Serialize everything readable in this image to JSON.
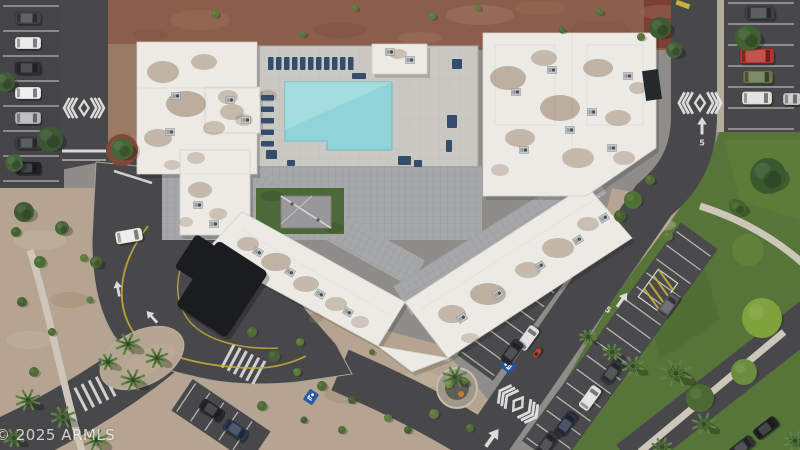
{
  "watermark": {
    "text": "© 2025 ARMLS"
  },
  "road_markings": {
    "speed_label": "5"
  },
  "palette": {
    "asphalt": "#48484a",
    "asphalt_dark": "#434345",
    "roof": "#eceae5",
    "stain": "#8b7057",
    "dirt": "#8b5e4c",
    "gravel": "#b5a491",
    "lawn": "#577539",
    "pool": "#8ed4d8",
    "deck": "#cac8c3",
    "tile": "#a6a7a9",
    "canopy": "#1b1c1f",
    "line_white": "#e8e8e6",
    "line_yellow": "#c8b13b",
    "courtyard_green": "#4c6a38",
    "sidewalk": "#cdc7ba",
    "furniture_blue": "#2b4767",
    "brick": "#7c3f33",
    "mulch": "#7c4a37"
  },
  "scene": {
    "stall_rows": [
      {
        "cx": 31,
        "cy": 94,
        "len": 176,
        "width": 56,
        "step": 25,
        "rot": 90,
        "apron": null
      },
      {
        "cx": 761,
        "cy": 67,
        "len": 128,
        "width": 66,
        "step": 21,
        "rot": 90,
        "apron": null
      },
      {
        "cx": 528,
        "cy": 295,
        "len": 170,
        "width": 40,
        "step": 17,
        "rot": -54,
        "apron": "#4a4a4c"
      },
      {
        "cx": 620,
        "cy": 345,
        "len": 260,
        "width": 42,
        "step": 17,
        "rot": -54,
        "apron": "#4a4a4c"
      },
      {
        "cx": 221,
        "cy": 421,
        "len": 84,
        "width": 34,
        "step": 17,
        "rot": 34,
        "apron": "#48484a"
      }
    ],
    "chevrons": [
      {
        "x": 84,
        "y": 108,
        "rot": 0,
        "s": 0.85
      },
      {
        "x": 700,
        "y": 103,
        "rot": 0,
        "s": 0.9
      },
      {
        "x": 518,
        "y": 404,
        "rot": 36,
        "s": 0.95
      }
    ],
    "arrows": [
      {
        "x": 702,
        "y": 126,
        "rot": 0,
        "s": 1
      },
      {
        "x": 622,
        "y": 300,
        "rot": 36,
        "s": 1
      },
      {
        "x": 492,
        "y": 438,
        "rot": 36,
        "s": 1.25
      },
      {
        "x": 268,
        "y": 186,
        "rot": 92,
        "s": 0.9
      },
      {
        "x": 118,
        "y": 289,
        "rot": -10,
        "s": 0.9
      },
      {
        "x": 152,
        "y": 317,
        "rot": -42,
        "s": 0.9
      }
    ],
    "speed_markers": [
      {
        "x": 702,
        "y": 143,
        "rot": 0
      },
      {
        "x": 608,
        "y": 310,
        "rot": 36
      }
    ],
    "handicap": [
      {
        "x": 508,
        "y": 366,
        "rot": -54
      },
      {
        "x": 311,
        "y": 397,
        "rot": 34
      },
      {
        "x": 572,
        "y": 252,
        "rot": -54
      },
      {
        "x": 578,
        "y": 266,
        "rot": -54
      }
    ],
    "cars": [
      {
        "x": 28,
        "y": 18,
        "rot": 0,
        "c": "#43464a"
      },
      {
        "x": 28,
        "y": 43,
        "rot": 0,
        "c": "#e7e7e5"
      },
      {
        "x": 28,
        "y": 68,
        "rot": 0,
        "c": "#2d3034"
      },
      {
        "x": 28,
        "y": 93,
        "rot": 0,
        "c": "#ecedee"
      },
      {
        "x": 28,
        "y": 118,
        "rot": 0,
        "c": "#b4b6b8"
      },
      {
        "x": 28,
        "y": 143,
        "rot": 0,
        "c": "#3c4043"
      },
      {
        "x": 28,
        "y": 168,
        "rot": 0,
        "c": "#202225"
      },
      {
        "x": 760,
        "y": 13,
        "rot": 0,
        "c": "#3f4245",
        "w": 30,
        "h": 13
      },
      {
        "x": 757,
        "y": 56,
        "rot": 0,
        "c": "#b5352d",
        "w": 34,
        "h": 15
      },
      {
        "x": 758,
        "y": 77,
        "rot": 0,
        "c": "#66754b",
        "w": 30,
        "h": 13
      },
      {
        "x": 757,
        "y": 98,
        "rot": 0,
        "c": "#dedfdd",
        "w": 30,
        "h": 13
      },
      {
        "x": 792,
        "y": 99,
        "rot": 0,
        "c": "#c8c9c9",
        "w": 18,
        "h": 12
      },
      {
        "x": 129,
        "y": 236,
        "rot": -10,
        "c": "#ebebe9",
        "w": 27,
        "h": 13
      },
      {
        "x": 528,
        "y": 338,
        "rot": -54,
        "c": "#dcdddc"
      },
      {
        "x": 512,
        "y": 352,
        "rot": -54,
        "c": "#2e3134"
      },
      {
        "x": 537,
        "y": 353,
        "rot": -54,
        "c": "#b3402f",
        "w": 11,
        "h": 6
      },
      {
        "x": 668,
        "y": 306,
        "rot": -54,
        "c": "#55585b"
      },
      {
        "x": 612,
        "y": 372,
        "rot": -54,
        "c": "#35383c"
      },
      {
        "x": 590,
        "y": 398,
        "rot": -54,
        "c": "#e0e1df"
      },
      {
        "x": 566,
        "y": 424,
        "rot": -54,
        "c": "#2a3347"
      },
      {
        "x": 547,
        "y": 444,
        "rot": -54,
        "c": "#33363a"
      },
      {
        "x": 212,
        "y": 410,
        "rot": 34,
        "c": "#26282b"
      },
      {
        "x": 236,
        "y": 430,
        "rot": 34,
        "c": "#2c3a50"
      },
      {
        "x": 766,
        "y": 428,
        "rot": -38,
        "c": "#202225"
      },
      {
        "x": 742,
        "y": 447,
        "rot": -38,
        "c": "#2f3134"
      }
    ],
    "furniture": [
      {
        "x": 268,
        "y": 57,
        "w": 5.5,
        "h": 13
      },
      {
        "x": 276,
        "y": 57,
        "w": 5.5,
        "h": 13
      },
      {
        "x": 284,
        "y": 57,
        "w": 5.5,
        "h": 13
      },
      {
        "x": 292,
        "y": 57,
        "w": 5.5,
        "h": 13
      },
      {
        "x": 300,
        "y": 57,
        "w": 5.5,
        "h": 13
      },
      {
        "x": 308,
        "y": 57,
        "w": 5.5,
        "h": 13
      },
      {
        "x": 316,
        "y": 57,
        "w": 5.5,
        "h": 13
      },
      {
        "x": 324,
        "y": 57,
        "w": 5.5,
        "h": 13
      },
      {
        "x": 332,
        "y": 57,
        "w": 5.5,
        "h": 13
      },
      {
        "x": 340,
        "y": 57,
        "w": 5.5,
        "h": 13
      },
      {
        "x": 348,
        "y": 57,
        "w": 5.5,
        "h": 13
      },
      {
        "x": 261,
        "y": 95,
        "w": 13,
        "h": 5.5
      },
      {
        "x": 261,
        "y": 106.5,
        "w": 13,
        "h": 5.5
      },
      {
        "x": 261,
        "y": 118,
        "w": 13,
        "h": 5.5
      },
      {
        "x": 261,
        "y": 129.5,
        "w": 13,
        "h": 5.5
      },
      {
        "x": 261,
        "y": 141,
        "w": 13,
        "h": 5.5
      },
      {
        "x": 266,
        "y": 150,
        "w": 11,
        "h": 9
      },
      {
        "x": 447,
        "y": 115,
        "w": 10,
        "h": 13
      },
      {
        "x": 398,
        "y": 156,
        "w": 13,
        "h": 9
      },
      {
        "x": 452,
        "y": 59,
        "w": 10,
        "h": 10
      },
      {
        "x": 414,
        "y": 160,
        "w": 8,
        "h": 7
      },
      {
        "x": 352,
        "y": 73,
        "w": 14,
        "h": 6
      },
      {
        "x": 287,
        "y": 160,
        "w": 8,
        "h": 6
      },
      {
        "x": 446,
        "y": 140,
        "w": 6,
        "h": 12
      }
    ],
    "ac_units": [
      {
        "x": 176,
        "y": 96,
        "rot": 0
      },
      {
        "x": 170,
        "y": 132,
        "rot": 0
      },
      {
        "x": 230,
        "y": 100,
        "rot": 0
      },
      {
        "x": 246,
        "y": 120,
        "rot": 0
      },
      {
        "x": 198,
        "y": 205,
        "rot": 0
      },
      {
        "x": 214,
        "y": 224,
        "rot": 0
      },
      {
        "x": 258,
        "y": 252,
        "rot": 30
      },
      {
        "x": 290,
        "y": 272,
        "rot": 30
      },
      {
        "x": 320,
        "y": 294,
        "rot": 30
      },
      {
        "x": 348,
        "y": 312,
        "rot": 30
      },
      {
        "x": 462,
        "y": 318,
        "rot": -32
      },
      {
        "x": 498,
        "y": 294,
        "rot": -32
      },
      {
        "x": 540,
        "y": 266,
        "rot": -32
      },
      {
        "x": 578,
        "y": 240,
        "rot": -32
      },
      {
        "x": 604,
        "y": 218,
        "rot": -32
      },
      {
        "x": 516,
        "y": 92,
        "rot": 0
      },
      {
        "x": 552,
        "y": 70,
        "rot": 0
      },
      {
        "x": 592,
        "y": 112,
        "rot": 0
      },
      {
        "x": 628,
        "y": 76,
        "rot": 0
      },
      {
        "x": 612,
        "y": 148,
        "rot": 0
      },
      {
        "x": 524,
        "y": 150,
        "rot": 0
      },
      {
        "x": 570,
        "y": 130,
        "rot": 0
      },
      {
        "x": 390,
        "y": 52,
        "rot": 0
      },
      {
        "x": 410,
        "y": 60,
        "rot": 0
      }
    ],
    "roof_stains": [
      {
        "x": 163,
        "y": 72,
        "rx": 16,
        "ry": 11,
        "o": 0.45
      },
      {
        "x": 204,
        "y": 62,
        "rx": 13,
        "ry": 8,
        "o": 0.4
      },
      {
        "x": 186,
        "y": 104,
        "rx": 20,
        "ry": 13,
        "o": 0.5
      },
      {
        "x": 158,
        "y": 138,
        "rx": 14,
        "ry": 9,
        "o": 0.42
      },
      {
        "x": 214,
        "y": 128,
        "rx": 11,
        "ry": 7,
        "o": 0.35
      },
      {
        "x": 232,
        "y": 112,
        "rx": 12,
        "ry": 8,
        "o": 0.4
      },
      {
        "x": 196,
        "y": 158,
        "rx": 9,
        "ry": 6,
        "o": 0.3
      },
      {
        "x": 172,
        "y": 165,
        "rx": 8,
        "ry": 5,
        "o": 0.3
      },
      {
        "x": 228,
        "y": 97,
        "rx": 10,
        "ry": 7,
        "o": 0.35
      },
      {
        "x": 244,
        "y": 120,
        "rx": 9,
        "ry": 6,
        "o": 0.3
      },
      {
        "x": 200,
        "y": 190,
        "rx": 12,
        "ry": 8,
        "o": 0.4
      },
      {
        "x": 218,
        "y": 214,
        "rx": 9,
        "ry": 6,
        "o": 0.33
      },
      {
        "x": 186,
        "y": 222,
        "rx": 7,
        "ry": 5,
        "o": 0.3
      },
      {
        "x": 248,
        "y": 244,
        "rx": 11,
        "ry": 7,
        "o": 0.4
      },
      {
        "x": 276,
        "y": 262,
        "rx": 15,
        "ry": 9,
        "o": 0.45
      },
      {
        "x": 306,
        "y": 284,
        "rx": 13,
        "ry": 8,
        "o": 0.4
      },
      {
        "x": 336,
        "y": 304,
        "rx": 11,
        "ry": 7,
        "o": 0.35
      },
      {
        "x": 360,
        "y": 322,
        "rx": 9,
        "ry": 6,
        "o": 0.3
      },
      {
        "x": 316,
        "y": 318,
        "rx": 7,
        "ry": 5,
        "o": 0.3
      },
      {
        "x": 452,
        "y": 314,
        "rx": 14,
        "ry": 9,
        "o": 0.42
      },
      {
        "x": 488,
        "y": 294,
        "rx": 18,
        "ry": 11,
        "o": 0.48
      },
      {
        "x": 528,
        "y": 270,
        "rx": 13,
        "ry": 8,
        "o": 0.4
      },
      {
        "x": 558,
        "y": 248,
        "rx": 16,
        "ry": 10,
        "o": 0.42
      },
      {
        "x": 588,
        "y": 224,
        "rx": 11,
        "ry": 7,
        "o": 0.35
      },
      {
        "x": 470,
        "y": 338,
        "rx": 9,
        "ry": 5,
        "o": 0.3
      },
      {
        "x": 508,
        "y": 78,
        "rx": 18,
        "ry": 12,
        "o": 0.48
      },
      {
        "x": 544,
        "y": 58,
        "rx": 13,
        "ry": 8,
        "o": 0.4
      },
      {
        "x": 560,
        "y": 108,
        "rx": 20,
        "ry": 13,
        "o": 0.5
      },
      {
        "x": 598,
        "y": 68,
        "rx": 15,
        "ry": 9,
        "o": 0.45
      },
      {
        "x": 618,
        "y": 118,
        "rx": 13,
        "ry": 8,
        "o": 0.4
      },
      {
        "x": 638,
        "y": 88,
        "rx": 9,
        "ry": 6,
        "o": 0.35
      },
      {
        "x": 520,
        "y": 138,
        "rx": 15,
        "ry": 9,
        "o": 0.42
      },
      {
        "x": 578,
        "y": 158,
        "rx": 16,
        "ry": 10,
        "o": 0.4
      },
      {
        "x": 624,
        "y": 158,
        "rx": 11,
        "ry": 7,
        "o": 0.35
      },
      {
        "x": 500,
        "y": 170,
        "rx": 9,
        "ry": 6,
        "o": 0.3
      },
      {
        "x": 398,
        "y": 54,
        "rx": 9,
        "ry": 5,
        "o": 0.35
      },
      {
        "x": 268,
        "y": 96,
        "rx": 9,
        "ry": 6,
        "o": 0.3
      }
    ],
    "trees": [
      {
        "x": 50,
        "y": 139,
        "r": 13,
        "c": "#3d5732"
      },
      {
        "x": 14,
        "y": 163,
        "r": 9,
        "c": "#44613a"
      },
      {
        "x": 5,
        "y": 82,
        "r": 10,
        "c": "#3f5c35"
      },
      {
        "x": 24,
        "y": 212,
        "r": 10,
        "c": "#3f5a33"
      },
      {
        "x": 62,
        "y": 228,
        "r": 7,
        "c": "#4a6639"
      },
      {
        "x": 122,
        "y": 149,
        "r": 11,
        "c": "#486538"
      },
      {
        "x": 768,
        "y": 176,
        "r": 18,
        "c": "#3a592e"
      },
      {
        "x": 660,
        "y": 28,
        "r": 11,
        "c": "#3e5c33"
      },
      {
        "x": 674,
        "y": 50,
        "r": 8,
        "c": "#44613a"
      },
      {
        "x": 748,
        "y": 38,
        "r": 13,
        "c": "#41602f"
      },
      {
        "x": 738,
        "y": 208,
        "r": 8,
        "c": "#46632f"
      },
      {
        "x": 96,
        "y": 262,
        "r": 6,
        "c": "#4a6639"
      }
    ],
    "palms": [
      {
        "x": 128,
        "y": 344,
        "r": 12
      },
      {
        "x": 157,
        "y": 358,
        "r": 11
      },
      {
        "x": 133,
        "y": 380,
        "r": 12
      },
      {
        "x": 108,
        "y": 362,
        "r": 9
      },
      {
        "x": 28,
        "y": 400,
        "r": 12
      },
      {
        "x": 63,
        "y": 417,
        "r": 12
      },
      {
        "x": 96,
        "y": 440,
        "r": 12
      },
      {
        "x": 14,
        "y": 438,
        "r": 10
      },
      {
        "x": 455,
        "y": 377,
        "r": 12
      },
      {
        "x": 676,
        "y": 373,
        "r": 16
      },
      {
        "x": 633,
        "y": 366,
        "r": 11
      },
      {
        "x": 704,
        "y": 424,
        "r": 12
      },
      {
        "x": 612,
        "y": 352,
        "r": 9
      },
      {
        "x": 662,
        "y": 447,
        "r": 10
      },
      {
        "x": 795,
        "y": 441,
        "r": 11
      },
      {
        "x": 588,
        "y": 337,
        "r": 8
      }
    ],
    "bushes": [
      {
        "x": 122,
        "y": 150,
        "r": 16,
        "c": "#7c4a37"
      },
      {
        "x": 215,
        "y": 14,
        "r": 4,
        "c": "#5d7a3b"
      },
      {
        "x": 303,
        "y": 34,
        "r": 3.5,
        "c": "#55733a"
      },
      {
        "x": 432,
        "y": 16,
        "r": 4,
        "c": "#5d7a3b"
      },
      {
        "x": 562,
        "y": 30,
        "r": 3.5,
        "c": "#4e6b34"
      },
      {
        "x": 641,
        "y": 37,
        "r": 4,
        "c": "#55733a"
      },
      {
        "x": 478,
        "y": 8,
        "r": 3,
        "c": "#5d7a3b"
      },
      {
        "x": 355,
        "y": 8,
        "r": 3,
        "c": "#5d7a3b"
      },
      {
        "x": 600,
        "y": 12,
        "r": 3.5,
        "c": "#55733a"
      },
      {
        "x": 16,
        "y": 232,
        "r": 5,
        "c": "#46612f"
      },
      {
        "x": 40,
        "y": 262,
        "r": 6,
        "c": "#4f6c36"
      },
      {
        "x": 84,
        "y": 258,
        "r": 4,
        "c": "#5d7a3b"
      },
      {
        "x": 22,
        "y": 302,
        "r": 5,
        "c": "#46612f"
      },
      {
        "x": 52,
        "y": 332,
        "r": 4,
        "c": "#4f6c36"
      },
      {
        "x": 90,
        "y": 300,
        "r": 3.5,
        "c": "#5d7a3b"
      },
      {
        "x": 34,
        "y": 372,
        "r": 5,
        "c": "#4f6c36"
      },
      {
        "x": 252,
        "y": 332,
        "r": 5,
        "c": "#4f6c36"
      },
      {
        "x": 274,
        "y": 356,
        "r": 6,
        "c": "#46612f"
      },
      {
        "x": 297,
        "y": 372,
        "r": 4,
        "c": "#5d7a3b"
      },
      {
        "x": 322,
        "y": 386,
        "r": 5,
        "c": "#4f6c36"
      },
      {
        "x": 352,
        "y": 400,
        "r": 4,
        "c": "#46612f"
      },
      {
        "x": 262,
        "y": 406,
        "r": 5,
        "c": "#4f6c36"
      },
      {
        "x": 388,
        "y": 418,
        "r": 4,
        "c": "#5d7a3b"
      },
      {
        "x": 304,
        "y": 420,
        "r": 3.5,
        "c": "#46612f"
      },
      {
        "x": 342,
        "y": 430,
        "r": 4,
        "c": "#4f6c36"
      },
      {
        "x": 408,
        "y": 430,
        "r": 4,
        "c": "#46612f"
      },
      {
        "x": 434,
        "y": 414,
        "r": 5,
        "c": "#5d7a3b"
      },
      {
        "x": 470,
        "y": 428,
        "r": 4,
        "c": "#4f6c36"
      },
      {
        "x": 300,
        "y": 342,
        "r": 4,
        "c": "#5d7a3b"
      },
      {
        "x": 372,
        "y": 352,
        "r": 3,
        "c": "#4f6c36"
      },
      {
        "x": 633,
        "y": 200,
        "r": 9,
        "c": "#4e7034"
      },
      {
        "x": 620,
        "y": 216,
        "r": 6,
        "c": "#46612f"
      },
      {
        "x": 650,
        "y": 180,
        "r": 5,
        "c": "#4f6c36"
      },
      {
        "x": 668,
        "y": 236,
        "r": 5,
        "c": "#5d7a3b"
      },
      {
        "x": 735,
        "y": 205,
        "r": 6,
        "c": "#46612f"
      },
      {
        "x": 449,
        "y": 384,
        "r": 4,
        "c": "#6f9046"
      },
      {
        "x": 465,
        "y": 381,
        "r": 3.5,
        "c": "#6f9046"
      },
      {
        "x": 762,
        "y": 318,
        "r": 20,
        "c": "#7fa23c"
      },
      {
        "x": 744,
        "y": 372,
        "r": 13,
        "c": "#6b8d3e"
      },
      {
        "x": 700,
        "y": 398,
        "r": 14,
        "c": "#4a6a31"
      }
    ]
  }
}
